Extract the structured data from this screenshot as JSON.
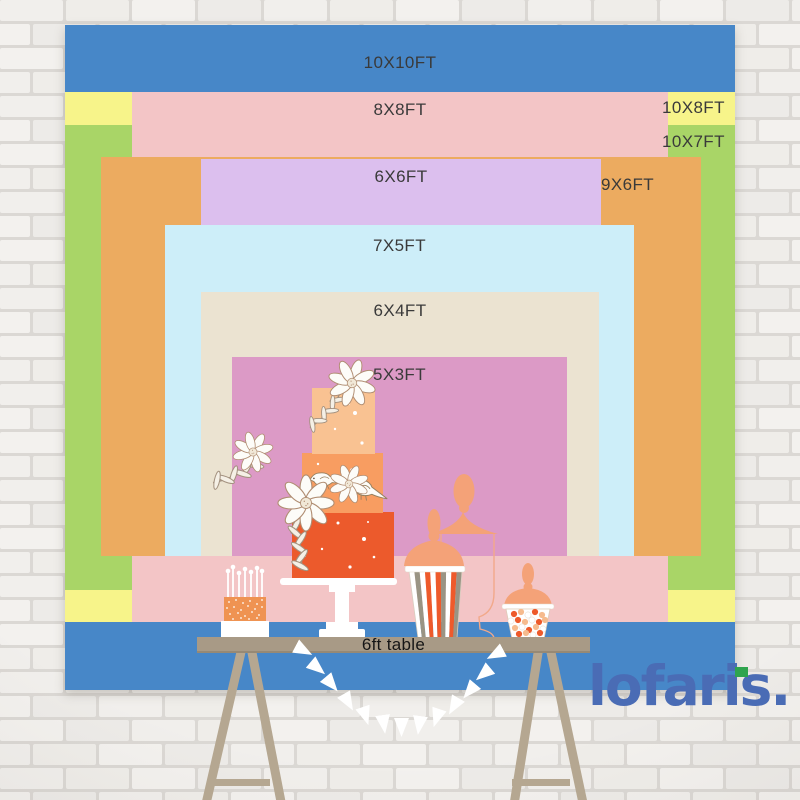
{
  "backdrop": {
    "sizes": [
      {
        "label": "10X10FT",
        "color": "#4787c8"
      },
      {
        "label": "8X8FT",
        "color": "#f3c5c6"
      },
      {
        "label": "10X8FT",
        "color": "#f7f48a"
      },
      {
        "label": "10X7FT",
        "color": "#a9d567"
      },
      {
        "label": "6X6FT",
        "color": "#dcbfee"
      },
      {
        "label": "9X6FT",
        "color": "#ecab60"
      },
      {
        "label": "7X5FT",
        "color": "#cdeef9"
      },
      {
        "label": "6X4FT",
        "color": "#ebe3d1"
      },
      {
        "label": "5X3FT",
        "color": "#dc9ac6"
      }
    ]
  },
  "table": {
    "label": "6ft table"
  },
  "brand": {
    "logo_text": "lofaris.",
    "logo_color": "#4a6cb5",
    "accent_color": "#2ea44e"
  },
  "decorations": [
    "cake-pops",
    "tiered-cake",
    "popcorn-jar",
    "apothecary-jar",
    "candy-jar",
    "bunting-garland",
    "white-brick-wall"
  ]
}
